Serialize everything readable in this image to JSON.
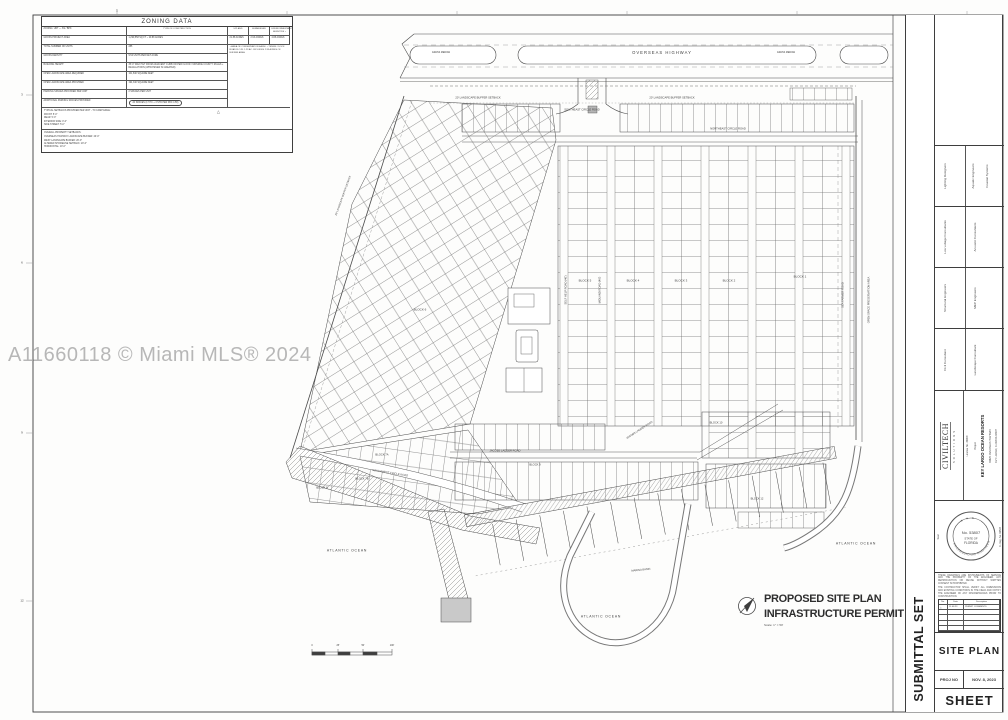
{
  "watermark": {
    "text": "A11660118 © Miami MLS® 2024"
  },
  "zoning": {
    "title": "ZONING DATA",
    "header": [
      "ZONING:  URT — SS / BPK",
      "TYPE OF CONSTRUCTION",
      "UPLAND",
      "SUBMERGED",
      "ENVIRONMENTALLY SENSITIVE +"
    ],
    "rows": [
      [
        "GROSS PROJECT AREA",
        "1,299,558 SQ FT ~ 29.88 ACRES",
        "21.88 ACRES",
        "2.93 ACRES",
        "4.88 ACRES"
      ],
      [
        "TOTAL NUMBER OF UNITS",
        "285"
      ],
      [
        "GROSS DENSITY",
        "9.54 UNITS PER NET ACRE"
      ],
      [
        "BUILDING HEIGHT",
        "35'-0\" MAX HGT FROM ADJACENT CURB OR PER FLOOD / MONROE COUNTY RULES + REGULATIONS (WHICHEVER IS GREATER)"
      ],
      [
        "OPEN LANDSCAPE AREA REQUIRED",
        "101,840 SQUARE FEET"
      ],
      [
        "OPEN LANDSCAPE AREA PROVIDED",
        "194,340 SQUARE FEET"
      ],
      [
        "PARKING SPACES PROVIDED PER UNIT",
        "2 SPACES PER UNIT"
      ],
      [
        "ADDITIONAL PARKING SPACES PROVIDED",
        "20 SPACES (17 HC + 3 STD PER FBC 4.58)"
      ]
    ],
    "side_note": "+  AREA OF CONSERVATION EASM. + TENNIS / DOCK ROAD R.O.W. 1.29 AC.  INCLUDES 2.93 ACRES OF BUFFER AREA",
    "cloud_marker": "△",
    "notes1_title": "TYPICAL SETBACKS PROVIDED PER UNIT - TO CAMP EDGE:",
    "notes1": [
      "FRONT:  5'-0\"",
      "REAR:  5'-0\"",
      "INTERIOR SIDE:  0'-0\"",
      "SIDE STREET:  5'-0\""
    ],
    "notes2_title": "OVERALL PROPERTY SETBACKS:",
    "notes2": [
      "OVERSEAS HIGHWAY LANDSCAPE BUFFER:  20'-0\"",
      "WEST LANDSCAPE BUFFER:  20'-0\"",
      "ALTERED SHORELINE SETBACK:  20'-0\"",
      "HORIZONTAL:  10'-0\""
    ]
  },
  "plan": {
    "caption": {
      "line1": "PROPOSED SITE PLAN",
      "line2": "INFRASTRUCTURE PERMIT ONLY",
      "scale": "Scale: 1\" = 50'"
    },
    "labels": [
      {
        "t": "OVERSEAS HIGHWAY",
        "x": 662,
        "y": 53,
        "s": 4.2,
        "ls": 1
      },
      {
        "t": "GRASS MEDIAN",
        "x": 441,
        "y": 53,
        "s": 2.4
      },
      {
        "t": "GRASS MEDIAN",
        "x": 786,
        "y": 53,
        "s": 2.4
      },
      {
        "t": "20' LANDSCAPE BUFFER SETBACK",
        "x": 478,
        "y": 99,
        "s": 2.7
      },
      {
        "t": "20' LANDSCAPE BUFFER SETBACK",
        "x": 672,
        "y": 99,
        "s": 2.7
      },
      {
        "t": "20' LANDSCAPE BUFFER SETBACK",
        "x": 344,
        "y": 196,
        "r": -70,
        "s": 2.5
      },
      {
        "t": "SOUTHEAST CIRCLE ROAD",
        "x": 582,
        "y": 111,
        "s": 2.7
      },
      {
        "t": "NORTHEAST CIRCLE ROAD",
        "x": 728,
        "y": 130,
        "s": 2.7
      },
      {
        "t": "SELF HELP ROAD (40')",
        "x": 567,
        "y": 290,
        "r": -90,
        "s": 2.7
      },
      {
        "t": "MIDLAND ROAD (40')",
        "x": 601,
        "y": 290,
        "r": -90,
        "s": 2.7
      },
      {
        "t": "SEA FARMER ROAD",
        "x": 844,
        "y": 295,
        "r": -90,
        "s": 2.7
      },
      {
        "t": "OPEN SPACE PRESERVATION AREA",
        "x": 870,
        "y": 300,
        "r": -90,
        "s": 2.7
      },
      {
        "t": "JACOBS LADDER ROAD",
        "x": 505,
        "y": 452,
        "s": 2.7
      },
      {
        "t": "JACOBS LADDER ROAD",
        "x": 640,
        "y": 431,
        "r": -33,
        "s": 2.7
      },
      {
        "t": "SOUTHWEST CIRCLE ROAD",
        "x": 390,
        "y": 474,
        "r": 9,
        "s": 2.7
      },
      {
        "t": "BLOCK 1",
        "x": 800,
        "y": 277,
        "s": 3
      },
      {
        "t": "BLOCK 2",
        "x": 729,
        "y": 281,
        "s": 3
      },
      {
        "t": "BLOCK 3",
        "x": 681,
        "y": 281,
        "s": 3
      },
      {
        "t": "BLOCK 4",
        "x": 633,
        "y": 281,
        "s": 3
      },
      {
        "t": "BLOCK 5",
        "x": 585,
        "y": 281,
        "s": 3
      },
      {
        "t": "BLOCK 6",
        "x": 420,
        "y": 310,
        "s": 3
      },
      {
        "t": "BLOCK 7A",
        "x": 382,
        "y": 456,
        "s": 2.7
      },
      {
        "t": "BLOCK 7B",
        "x": 362,
        "y": 480,
        "s": 2.7
      },
      {
        "t": "BLOCK 8",
        "x": 322,
        "y": 489,
        "s": 2.7
      },
      {
        "t": "BLOCK 9",
        "x": 535,
        "y": 466,
        "s": 2.7
      },
      {
        "t": "BLOCK 10",
        "x": 716,
        "y": 424,
        "s": 2.7
      },
      {
        "t": "BLOCK 12",
        "x": 757,
        "y": 500,
        "s": 2.7
      },
      {
        "t": "ATLANTIC OCEAN",
        "x": 347,
        "y": 551,
        "s": 3.4,
        "ls": 0.8
      },
      {
        "t": "ATLANTIC OCEAN",
        "x": 601,
        "y": 617,
        "s": 3.4,
        "ls": 0.8
      },
      {
        "t": "ATLANTIC OCEAN",
        "x": 856,
        "y": 544,
        "s": 3.4,
        "ls": 0.8
      },
      {
        "t": "MARINA BASIN",
        "x": 641,
        "y": 571,
        "r": -6,
        "s": 2.7
      },
      {
        "t": "0",
        "x": 312,
        "y": 646,
        "s": 2.4
      },
      {
        "t": "25'",
        "x": 338,
        "y": 646,
        "s": 2.4
      },
      {
        "t": "50'",
        "x": 363,
        "y": 646,
        "s": 2.4
      },
      {
        "t": "100'",
        "x": 392,
        "y": 646,
        "s": 2.4
      },
      {
        "t": "1",
        "x": 117,
        "y": 11,
        "s": 3
      },
      {
        "t": "3",
        "x": 22,
        "y": 95,
        "s": 3
      },
      {
        "t": "6",
        "x": 22,
        "y": 263,
        "s": 3
      },
      {
        "t": "9",
        "x": 22,
        "y": 433,
        "s": 3
      },
      {
        "t": "12",
        "x": 22,
        "y": 601,
        "s": 3
      }
    ]
  },
  "titleblock": {
    "submittal": "SUBMITTAL SET",
    "consultants": [
      "Lighting Designers",
      "Aquatic Engineers",
      "Coastal Systems",
      "Low voltage Consultants",
      "Acoustic Consultants",
      "Structural Engineers",
      "MEP Engineers",
      "Civil Consultant",
      "Landscape Consultant"
    ],
    "firm": "CIVILTECH",
    "firm_sub": "SOLUTIONS",
    "license": "License No. 34809",
    "project_label": "Project",
    "project_name": "KEY LARGO OCEAN RESORTS",
    "project_addr1": "94825 OVERSEAS HIGHWAY",
    "project_addr2": "KEY LARGO, FLORIDA 33037",
    "seal_label": "Seal",
    "seal_no": "No. 53807",
    "seal_l1": "STATE OF",
    "seal_l2": "FLORIDA",
    "seal_rim_top": "★ ★ ★",
    "seal_rim": "PROFESSIONAL ENGINEER",
    "reg_note": "FL Reg. No. 66507",
    "disclaimer1": "THESE DRAWINGS ARE INSTRUMENTS OF SERVICE AND THE PROPERTY OF THE ENGINEER. ANY REPRODUCTION OR REUSE WITHOUT WRITTEN CONSENT IS PROHIBITED.",
    "disclaimer2": "THE CONTRACTOR SHALL VERIFY ALL DIMENSIONS AND EXISTING CONDITIONS IN THE FIELD AND NOTIFY THE ENGINEER OF ANY DISCREPANCIES PRIOR TO CONSTRUCTION.",
    "rev_headers": [
      "No.",
      "Date",
      "Description"
    ],
    "rev_row": [
      "△",
      "11.08.23",
      "PERMIT COMMENTS"
    ],
    "sheet_title": "SITE PLAN",
    "proj_no_label": "PROJ NO",
    "date": "NOV. 8, 2023",
    "sheet_label": "SHEET"
  }
}
